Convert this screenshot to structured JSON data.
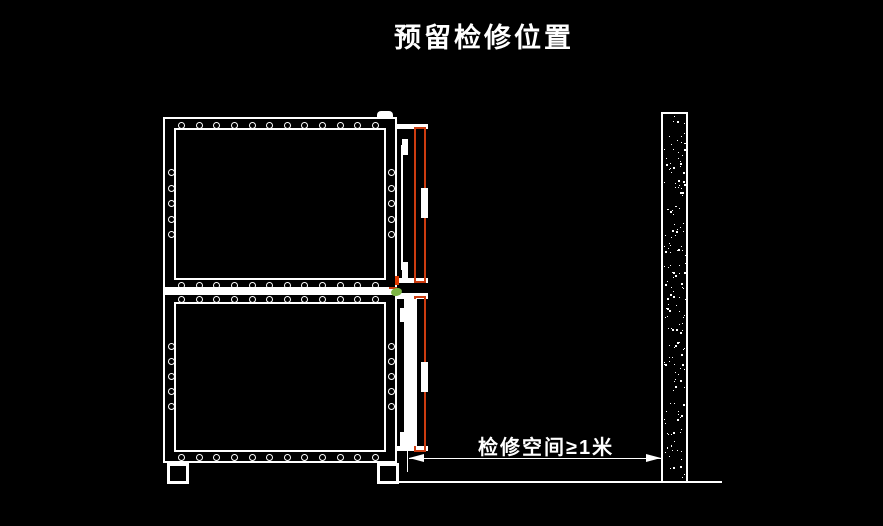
{
  "title": "预留检修位置",
  "dimension": {
    "label": "检修空间≥1米"
  },
  "colors": {
    "background": "#000000",
    "line": "#ffffff",
    "door_outline": "#cc3c10",
    "latch_red": "#e03a00",
    "latch_green": "#7db544"
  }
}
